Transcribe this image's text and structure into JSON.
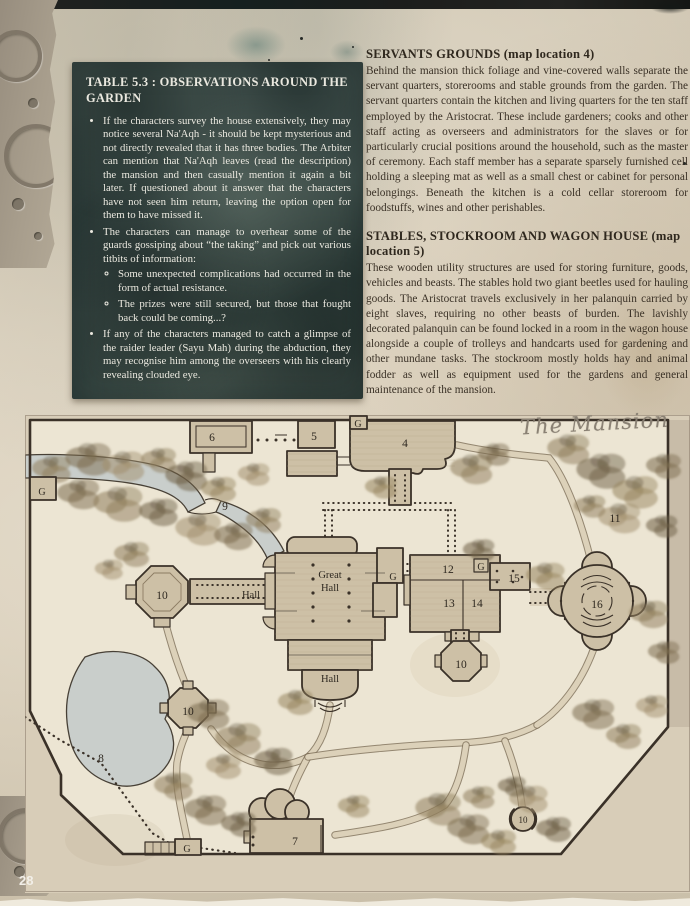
{
  "palette": {
    "page_bg": "#d3c8b4",
    "table_box_bg": "#41504c",
    "table_text": "#eae8df",
    "body_text": "#3a3126",
    "map_ink": "#3a3128",
    "map_parchment": "#ece5d3",
    "water": "#c9cecb",
    "script_color": "#8a8174"
  },
  "page": {
    "number": "28"
  },
  "table_box": {
    "title": "TABLE 5.3 : OBSERVATIONS AROUND THE GARDEN",
    "bullets": [
      {
        "text": "If the characters survey the house extensively, they may notice several Na'Aqh - it should be kept mysterious and not directly revealed that it has three bodies. The Arbiter can mention that Na'Aqh leaves (read the description) the mansion and then casually mention it again a bit later. If questioned about it answer that the characters have not seen him return, leaving the option open for them to have missed it."
      },
      {
        "text": "The characters can manage to overhear some of the guards gossiping about “the taking” and pick out various titbits of information:",
        "sub": [
          "Some unexpected complications had occurred in the form of actual resistance.",
          "The prizes were still secured, but those that fought back could be coming...?"
        ]
      },
      {
        "text": "If any of the characters managed to catch a glimpse of the raider leader (Sayu Mah) during the abduction, they may recognise him among the overseers with his clearly revealing clouded eye."
      }
    ]
  },
  "right_column": {
    "sections": [
      {
        "heading": "SERVANTS GROUNDS (map location 4)",
        "body": "Behind the mansion thick foliage and vine-covered walls separate the servant quarters, storerooms and stable grounds from the garden. The servant quarters contain the kitchen and living quarters for the ten staff employed by the Aristocrat. These include gardeners; cooks and other staff acting as overseers and administrators for the slaves or for particularly crucial positions around the household, such as the master of ceremony. Each staff member has a separate sparsely furnished cell holding a sleeping mat as well as a small chest or cabinet for personal belongings. Beneath the kitchen is a cold cellar storeroom for foodstuffs, wines and other perishables."
      },
      {
        "heading": "STABLES, STOCKROOM AND WAGON HOUSE (map location 5)",
        "body": "These wooden utility structures are used for storing furniture, goods, vehicles and beasts. The stables hold two giant beetles used for hauling goods. The Aristocrat travels exclusively in her palanquin carried by eight slaves, requiring no other beasts of burden. The lavishly decorated palanquin can be found locked in a room in the wagon house alongside a couple of trolleys and handcarts used for gardening and other mundane tasks. The stockroom mostly holds hay and animal fodder as well as equipment used for the gardens and general maintenance of the mansion."
      }
    ]
  },
  "map_caption": "The Mansion",
  "map": {
    "labels": {
      "gate_top": "G",
      "loc6": "6",
      "loc5": "5",
      "loc4": "4",
      "gate_left": "G",
      "loc9": "9",
      "loc11": "11",
      "loc12": "12",
      "gate_court": "G",
      "loc15": "15",
      "gate_hall": "G",
      "great_hall_line1": "Great",
      "great_hall_line2": "Hall",
      "hall_west": "Hall",
      "loc10_west": "10",
      "loc13": "13",
      "loc14": "14",
      "loc16": "16",
      "loc10_east": "10",
      "hall_south": "Hall",
      "loc10_garden": "10",
      "loc8": "8",
      "loc7": "7",
      "gate_bottom": "G",
      "loc10_pavilion": "10"
    }
  }
}
